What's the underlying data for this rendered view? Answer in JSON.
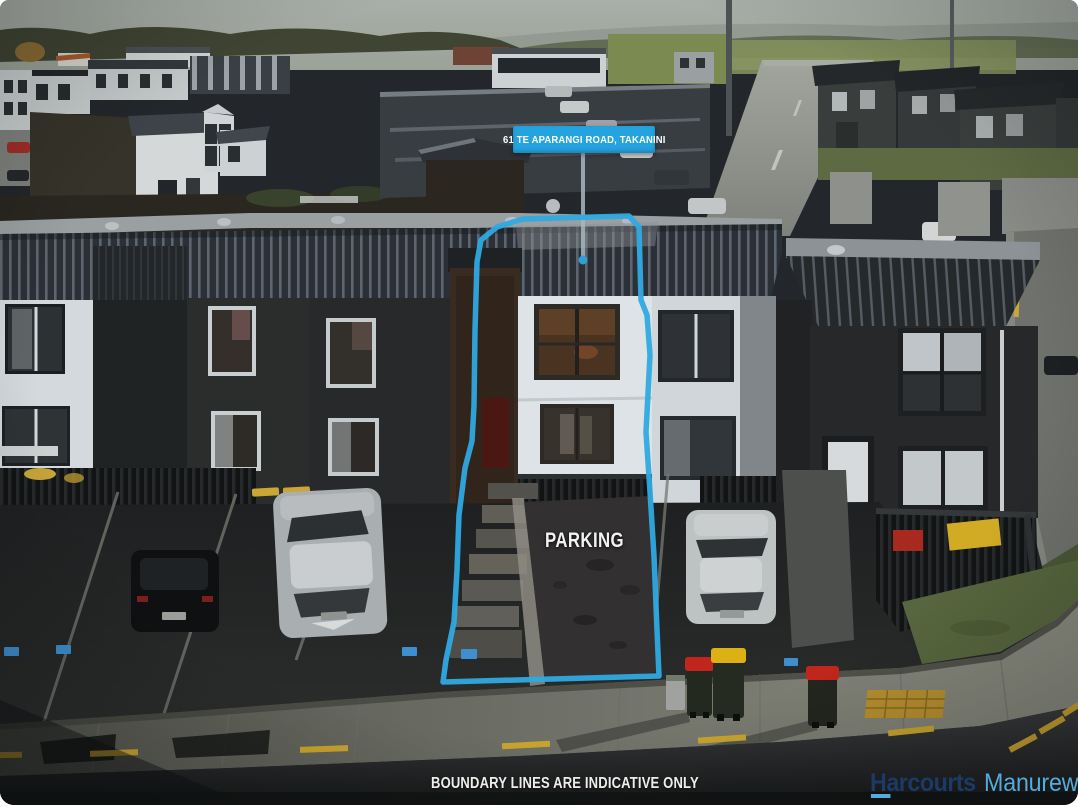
{
  "photo": {
    "type": "aerial-drone-listing-photo",
    "address_banner": "61 TE APARANGI ROAD, TAKANINI",
    "parking_label": "PARKING",
    "disclaimer": "BOUNDARY LINES ARE INDICATIVE ONLY"
  },
  "branding": {
    "agency": "Harcourts",
    "office": "Manurewa"
  },
  "colors": {
    "boundary_blue": "#2FA9E1",
    "banner_blue": "#24A3DE",
    "brand_navy": "#1C3A66",
    "brand_light_blue": "#55ABDB",
    "disclaimer_white": "#EDEEEC",
    "road_marking_yellow": "#C9A42E"
  }
}
